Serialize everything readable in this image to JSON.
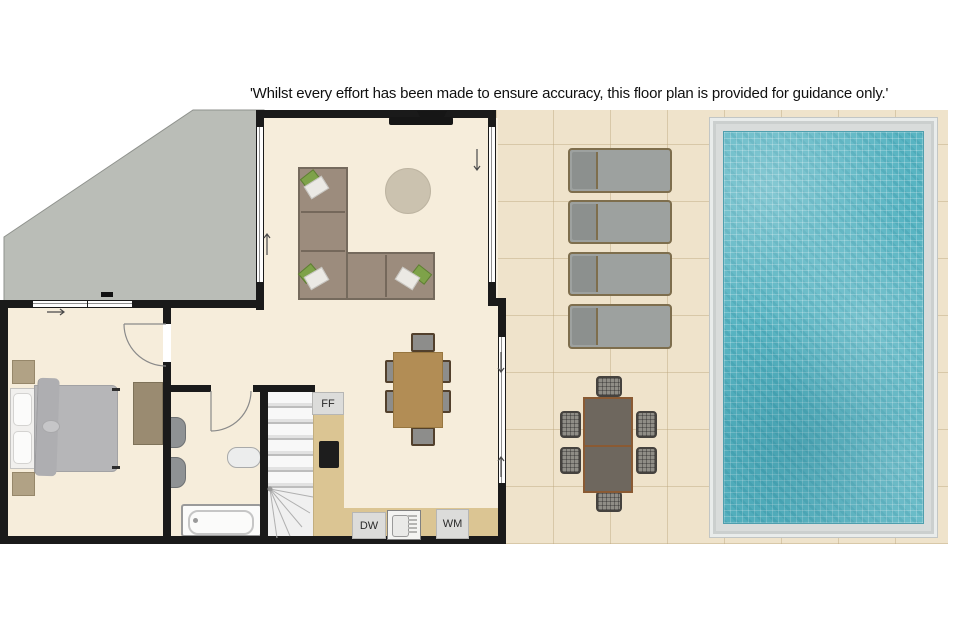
{
  "disclaimer": "'Whilst every effort has been made to ensure accuracy, this floor plan is provided for guidance only.'",
  "labels": {
    "fridge_freezer": "FF",
    "dishwasher": "DW",
    "washing_machine": "WM"
  },
  "colors": {
    "wall": "#1a1a1a",
    "interior_floor": "#f6eddb",
    "terrace": "#babdb7",
    "patio": "#efe3cb",
    "counter_wood": "#dbc593",
    "pool_water": "#58b4c2",
    "pool_coping": "#d9dcdb",
    "sofa": "#9c8c7d",
    "cushion_accent": "#7ea249"
  },
  "counts": {
    "sun_loungers": 4,
    "outdoor_dining_chairs": 6,
    "indoor_dining_chairs": 6
  }
}
